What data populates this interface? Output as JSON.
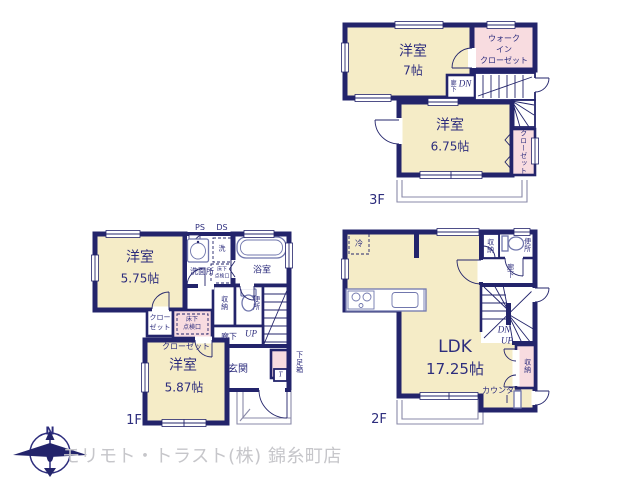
{
  "branding": {
    "company": "モリモト・トラスト(株) 錦糸町店",
    "compass_n": "N"
  },
  "colors": {
    "wall": "#23246b",
    "room_fill": "#f5ecc7",
    "closet_fill": "#f8dce0",
    "label_text": "#2d2d7d",
    "logo_text": "#c6c6ca"
  },
  "floors": {
    "f3": {
      "label": "3F",
      "room1_name": "洋室",
      "room1_size": "7帖",
      "wic_line1": "ウォーク",
      "wic_line2": "イン",
      "wic_line3": "クローゼット",
      "hall": "廊下",
      "dn": "DN",
      "room2_name": "洋室",
      "room2_size": "6.75帖",
      "closet": "クローゼット"
    },
    "f1": {
      "label": "1F",
      "ps": "PS",
      "ds": "DS",
      "room1_name": "洋室",
      "room1_size": "5.75帖",
      "laundry": "洗",
      "washroom": "洗面所",
      "hatch1_line1": "床下",
      "hatch1_line2": "点検口",
      "bathroom": "浴室",
      "closet1_line1": "クロー",
      "closet1_line2": "ゼット",
      "hatch2_line1": "床下",
      "hatch2_line2": "点検口",
      "closet2": "クローゼット",
      "storage": "収納",
      "toilet": "便所",
      "hall": "廊下",
      "up": "UP",
      "entrance": "玄関",
      "shoebox": "下足箱",
      "t_mark": "T",
      "room2_name": "洋室",
      "room2_size": "5.87帖"
    },
    "f2": {
      "label": "2F",
      "fridge": "冷",
      "ldk_name": "LDK",
      "ldk_size": "17.25帖",
      "storage_top": "収納",
      "toilet": "便所",
      "hall": "廊下",
      "dn": "DN",
      "up": "UP",
      "storage_right": "収納",
      "counter": "カウンター"
    }
  }
}
